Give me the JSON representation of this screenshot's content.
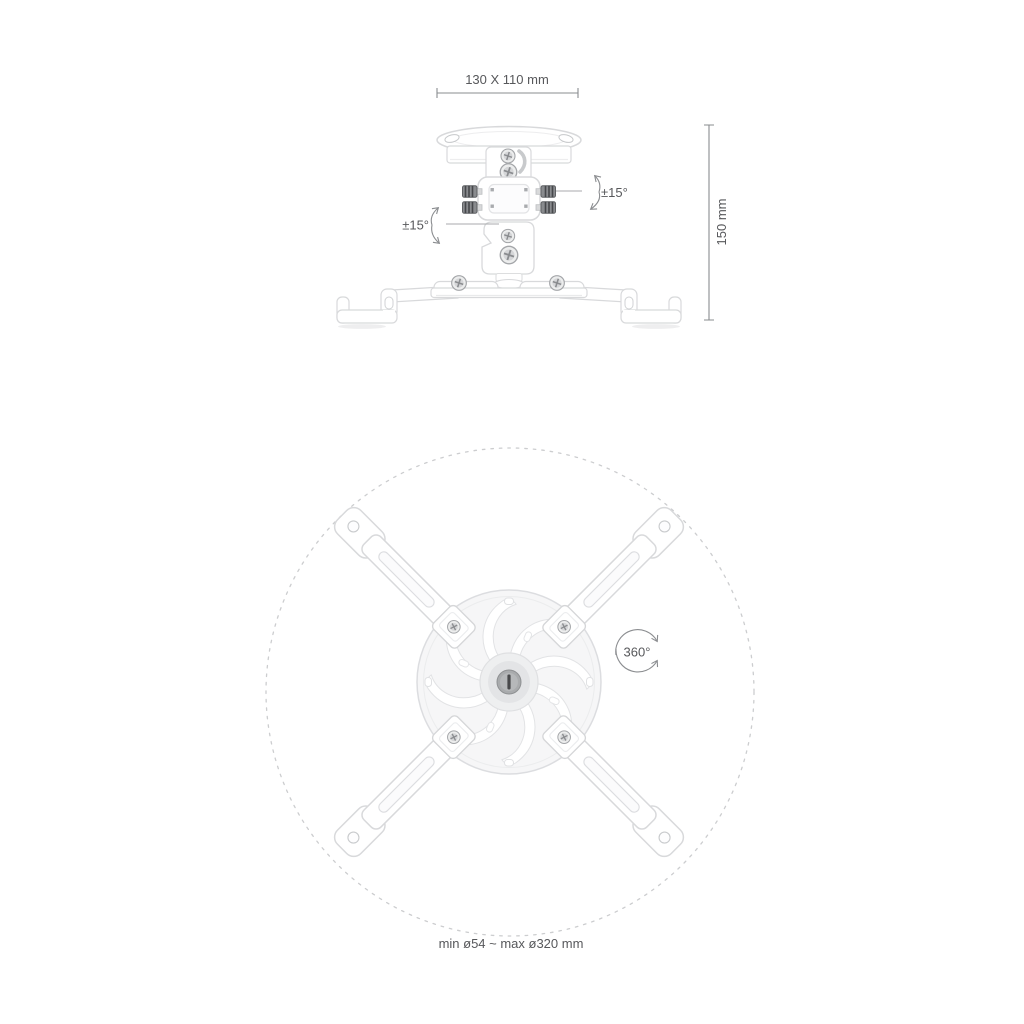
{
  "canvas": {
    "width": 1024,
    "height": 1024,
    "background": "#ffffff"
  },
  "colors": {
    "label_text": "#57585b",
    "dimension_line": "#8a8c8f",
    "leader_line": "#a8aaac",
    "arrow_arc": "#8b8d90",
    "dashed_guide_circle": "#cccdcf",
    "product_outline": "#d8d9db",
    "product_fill": "#ffffff",
    "product_shading": "#ededee",
    "screw_metal": "#a4a6a9",
    "knob_dark": "#46484b"
  },
  "front_view": {
    "width_dimension_label": "130 X 110 mm",
    "height_dimension_label": "150 mm",
    "tilt_left_label": "±15°",
    "tilt_right_label": "±15°"
  },
  "bottom_view": {
    "rotation_label": "360°",
    "diameter_range_label": "min ø54 ~ max ø320 mm"
  }
}
